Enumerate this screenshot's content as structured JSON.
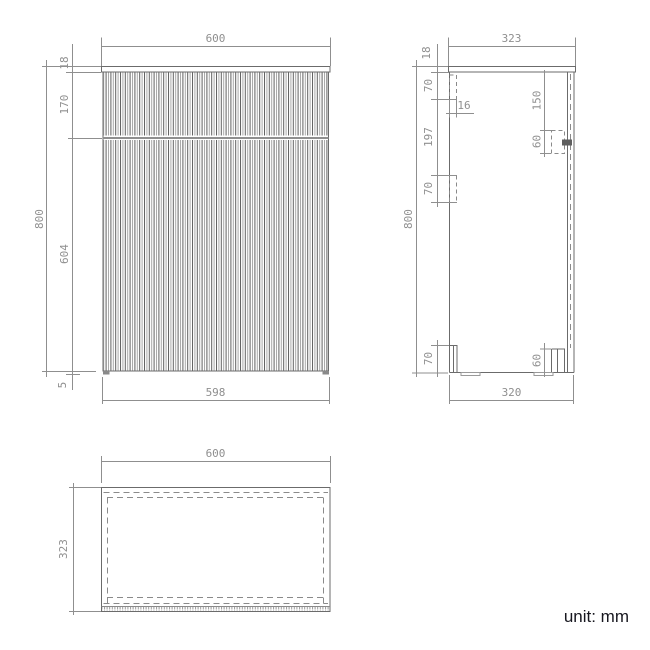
{
  "unit_label": "unit: mm",
  "colors": {
    "background": "#ffffff",
    "outline": "#6b6b6b",
    "hidden_line": "#8a8a8a",
    "flute_dark": "#5f5f5f",
    "flute_light": "#a8a8a8",
    "dimension": "#8f8f8f",
    "note_text": "#17171f"
  },
  "views": {
    "front": {
      "dimensions": {
        "overall_width": "600",
        "overall_height": "800",
        "top_panel_thickness": "18",
        "drawer_front_height": "170",
        "door_front_height": "604",
        "bottom_clearance": "5",
        "front_panel_width": "598"
      }
    },
    "side": {
      "dimensions": {
        "overall_depth": "323",
        "overall_height": "800",
        "top_panel_thickness": "18",
        "top_rail_drop": "70",
        "rail_thickness": "16",
        "rail_spacing": "197",
        "mid_rail_height": "70",
        "bracket_drop": "150",
        "bracket_height": "60",
        "bottom_left_block_height": "70",
        "bottom_right_block_height": "60",
        "body_depth": "320"
      }
    },
    "top": {
      "dimensions": {
        "overall_width": "600",
        "overall_depth": "323"
      }
    }
  }
}
